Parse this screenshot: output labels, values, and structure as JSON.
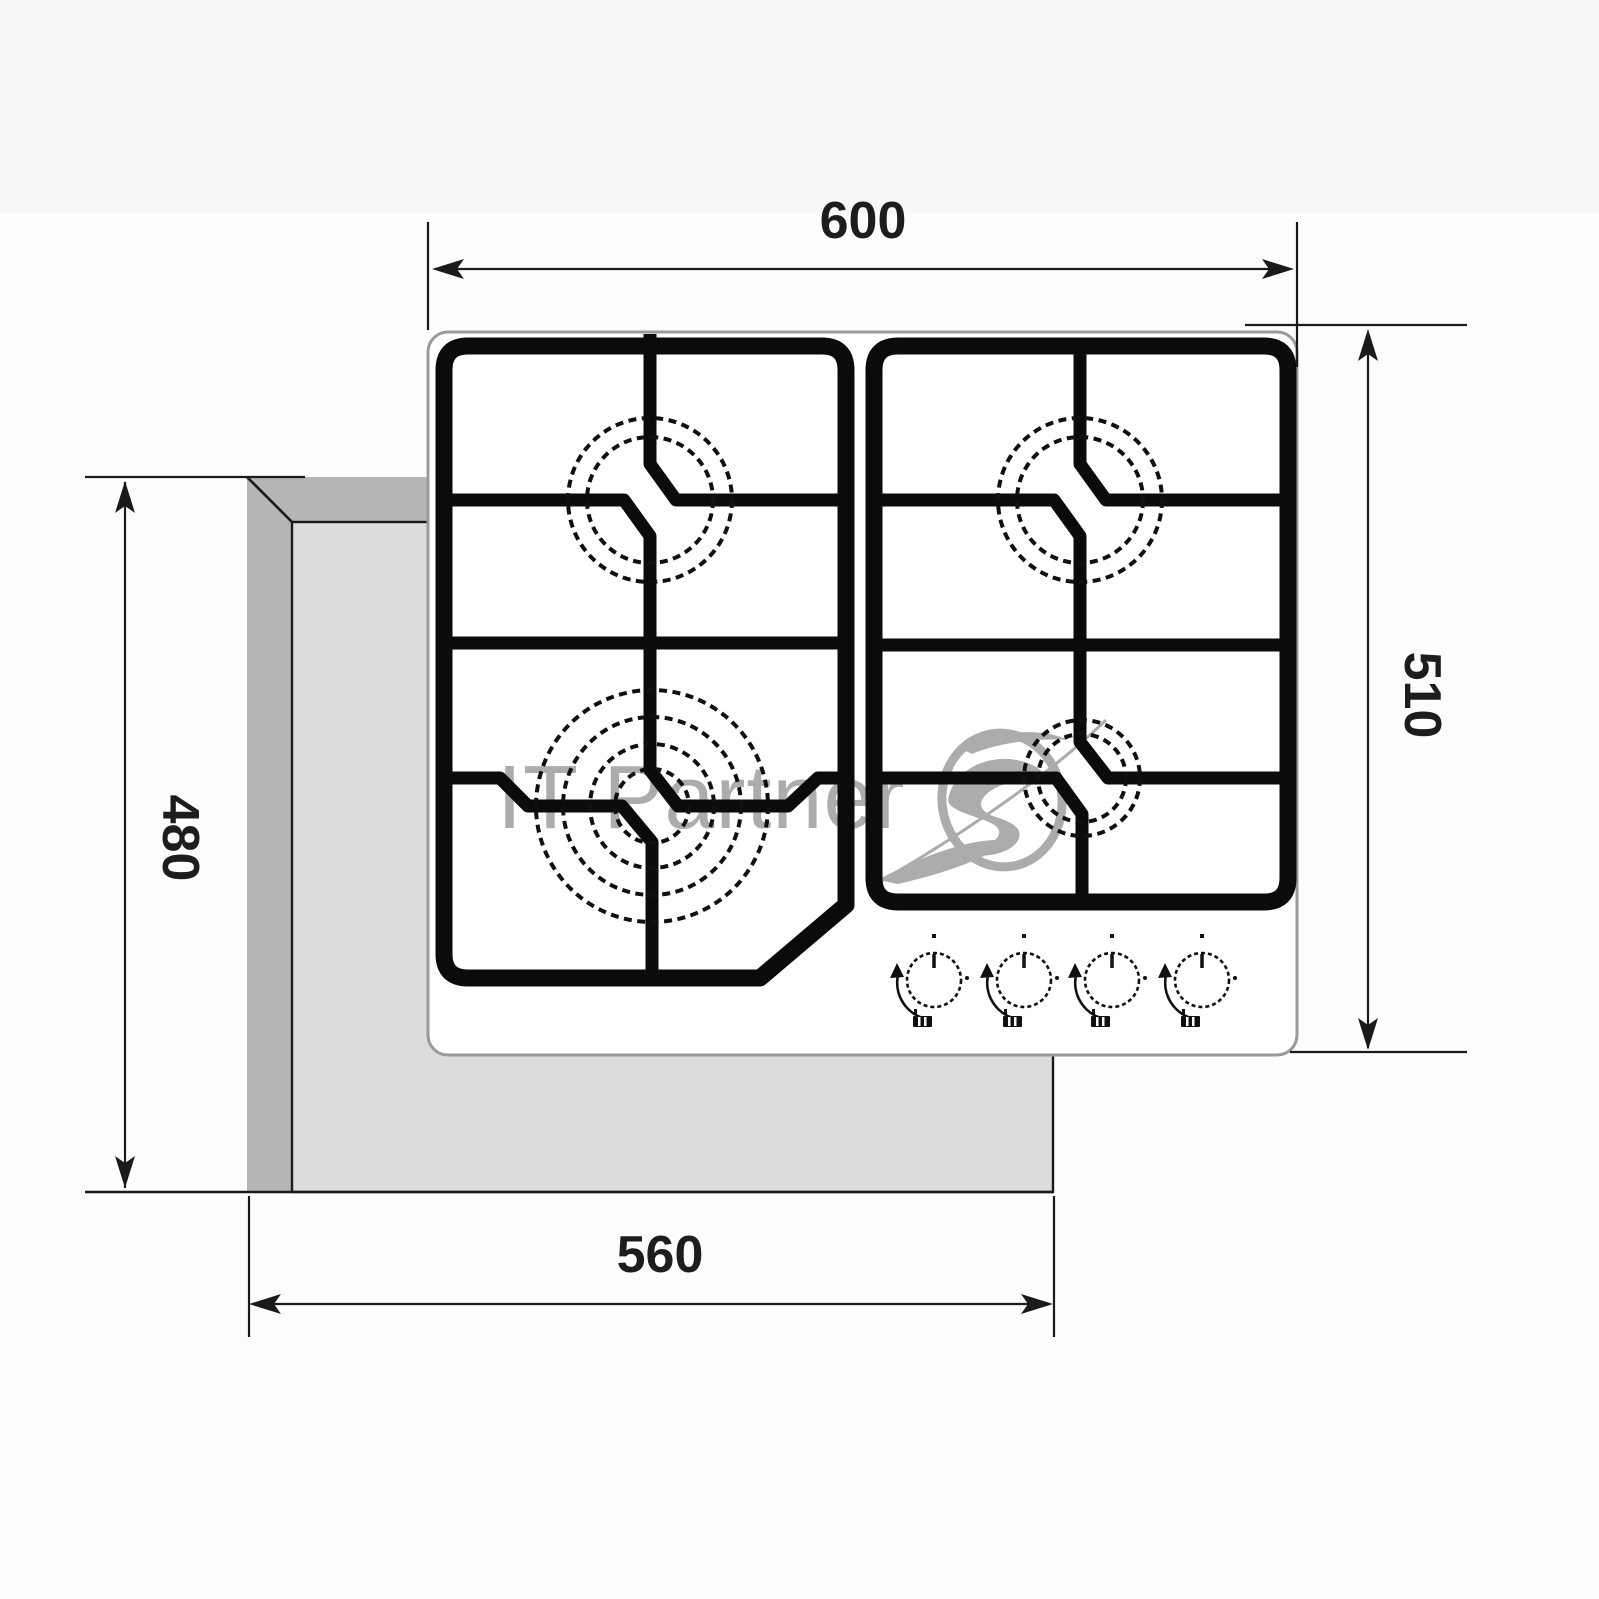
{
  "drawing": {
    "type": "appliance installation diagram",
    "subject": "4-burner gas hob top view with worktop cut-out",
    "units_shown": "none (bare numbers, millimetres implied)"
  },
  "dimensions": {
    "top": {
      "label": "hob overall width",
      "value": "600"
    },
    "right": {
      "label": "hob overall depth",
      "value": "510"
    },
    "left": {
      "label": "cut-out depth",
      "value": "480"
    },
    "bottom": {
      "label": "cut-out width",
      "value": "560"
    }
  },
  "watermark": {
    "text": "IT Partner",
    "color": "#9b9b9b"
  },
  "hob": {
    "burners": [
      {
        "position": "front-left",
        "size": "large (wok), 4 rings"
      },
      {
        "position": "back-left",
        "size": "medium, 2 rings"
      },
      {
        "position": "back-right",
        "size": "medium, 2 rings"
      },
      {
        "position": "front-right",
        "size": "small, 2 rings"
      }
    ],
    "knob_count": 4
  },
  "colors": {
    "line": "#1a1a1a",
    "grate": "#0b0b0b",
    "hob_fill": "#ffffff",
    "hob_outline": "#9a9a9a",
    "worktop_edge_dark": "#b5b5b5",
    "worktop_face_light": "#dcdcdc",
    "top_band_bg": "#f7f7f8",
    "page_bg": "#fdfdfd"
  }
}
